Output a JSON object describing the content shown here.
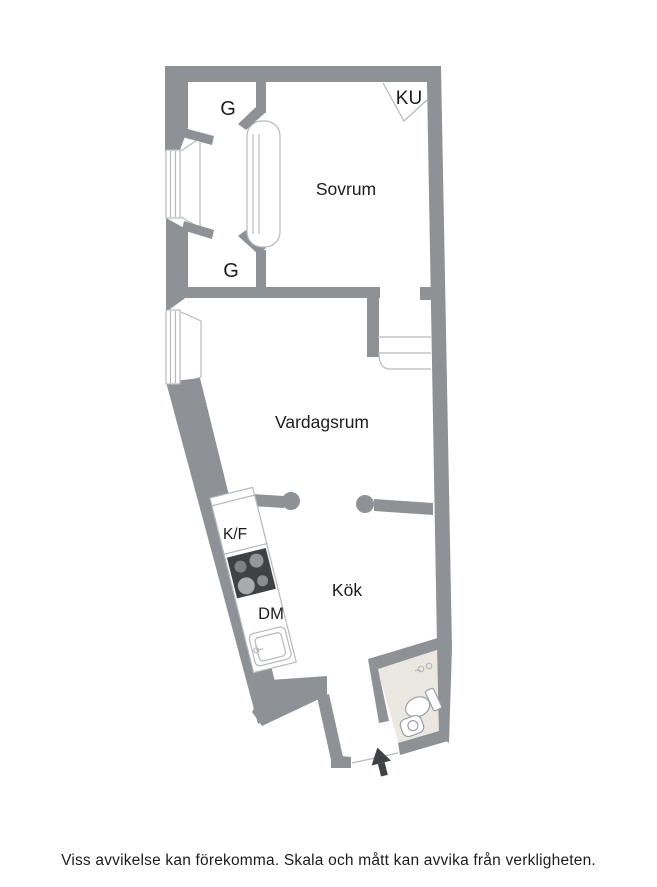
{
  "figure": {
    "type": "apartment-floorplan"
  },
  "floorplan": {
    "labels": {
      "sovrum": "Sovrum",
      "vardagsrum": "Vardagsrum",
      "kok": "Kök",
      "g_top": "G",
      "g_bottom": "G",
      "ku": "KU",
      "kf": "K/F",
      "dm": "DM"
    },
    "fixtures": [
      "window",
      "window",
      "sliding-door",
      "radiator",
      "kitchen-counter",
      "fridge-freezer",
      "stove",
      "dishwasher",
      "kitchen-sink",
      "toilet",
      "bathroom-sink",
      "vent",
      "entrance-arrow",
      "pillar",
      "pillar"
    ],
    "colors": {
      "wall": "#8e9296",
      "thin_line": "#b6b9bc",
      "fixture_line": "#9aa0a4",
      "bathroom_floor": "#eae8e1",
      "stove": "#3f4245",
      "burner": "#96999d",
      "arrow": "#3f4347",
      "text": "#1a1c1e"
    }
  },
  "footer": {
    "disclaimer": "Viss avvikelse kan förekomma. Skala och mått kan avvika från verkligheten."
  }
}
